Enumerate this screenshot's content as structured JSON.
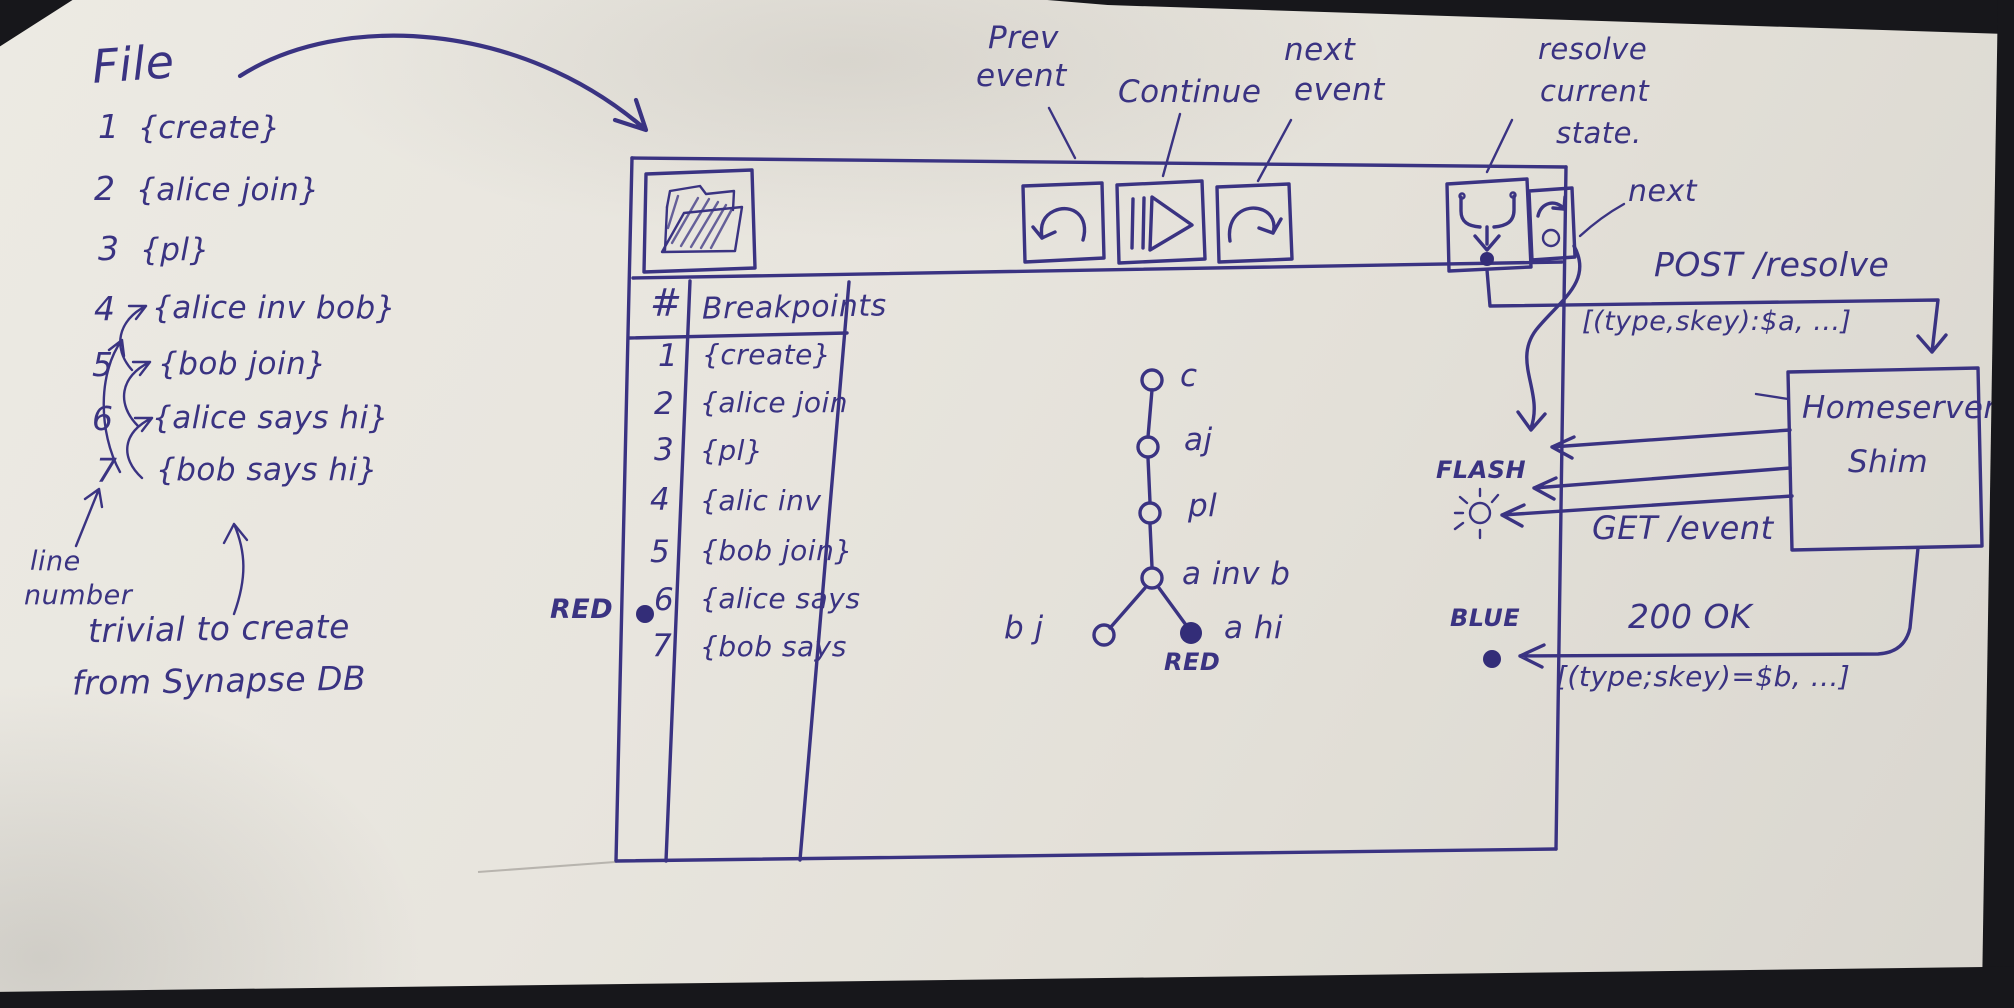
{
  "colors": {
    "ink": "#3a3382",
    "paper": "#e7e4dc",
    "photo_edge": "#17171b",
    "red_note": "RED",
    "blue_note": "BLUE"
  },
  "file_panel": {
    "title": "File",
    "lines": [
      {
        "num": "1",
        "text": "{create}"
      },
      {
        "num": "2",
        "text": "{alice join}"
      },
      {
        "num": "3",
        "text": "{pl}"
      },
      {
        "num": "4",
        "text": "{alice inv bob}"
      },
      {
        "num": "5",
        "text": "{bob join}"
      },
      {
        "num": "6",
        "text": "{alice says hi}"
      },
      {
        "num": "7",
        "text": "{bob says hi}"
      }
    ],
    "line_note_l1": "line",
    "line_note_l2": "number",
    "synapse_note_l1": "trivial to create",
    "synapse_note_l2": "from Synapse DB"
  },
  "toolbar": {
    "open_file_icon": "open-folder",
    "prev_label_l1": "Prev",
    "prev_label_l2": "event",
    "continue_label": "Continue",
    "next_event_label_l1": "next",
    "next_event_label_l2": "event",
    "resolve_label_l1": "resolve",
    "resolve_label_l2": "current",
    "resolve_label_l3": "state.",
    "next_button_label": "next"
  },
  "breakpoints": {
    "col_num": "#",
    "col_name": "Breakpoints",
    "rows": [
      {
        "num": "1",
        "text": "{create}"
      },
      {
        "num": "2",
        "text": "{alice join"
      },
      {
        "num": "3",
        "text": "{pl}"
      },
      {
        "num": "4",
        "text": "{alic inv"
      },
      {
        "num": "5",
        "text": "{bob join}"
      },
      {
        "num": "6",
        "text": "{alice says"
      },
      {
        "num": "7",
        "text": "{bob says"
      }
    ],
    "red_marker": "RED",
    "breakpoint_row": "6"
  },
  "graph": {
    "nodes": [
      {
        "id": "c",
        "label": "c"
      },
      {
        "id": "aj",
        "label": "aj"
      },
      {
        "id": "pl",
        "label": "pl"
      },
      {
        "id": "inv",
        "label": "a inv b"
      },
      {
        "id": "bj",
        "label": "b j"
      },
      {
        "id": "ahi",
        "label": "a hi",
        "filled": true
      }
    ],
    "red_marker": "RED"
  },
  "flow": {
    "post_label": "POST /resolve",
    "post_payload": "[(type,skey):$a, ...]",
    "homeserver_l1": "Homeserver",
    "homeserver_l2": "Shim",
    "flash_label": "FLASH",
    "get_label": "GET /event",
    "blue_label": "BLUE",
    "ok_label": "200 OK",
    "ok_payload": "[(type;skey)=$b, ...]"
  }
}
